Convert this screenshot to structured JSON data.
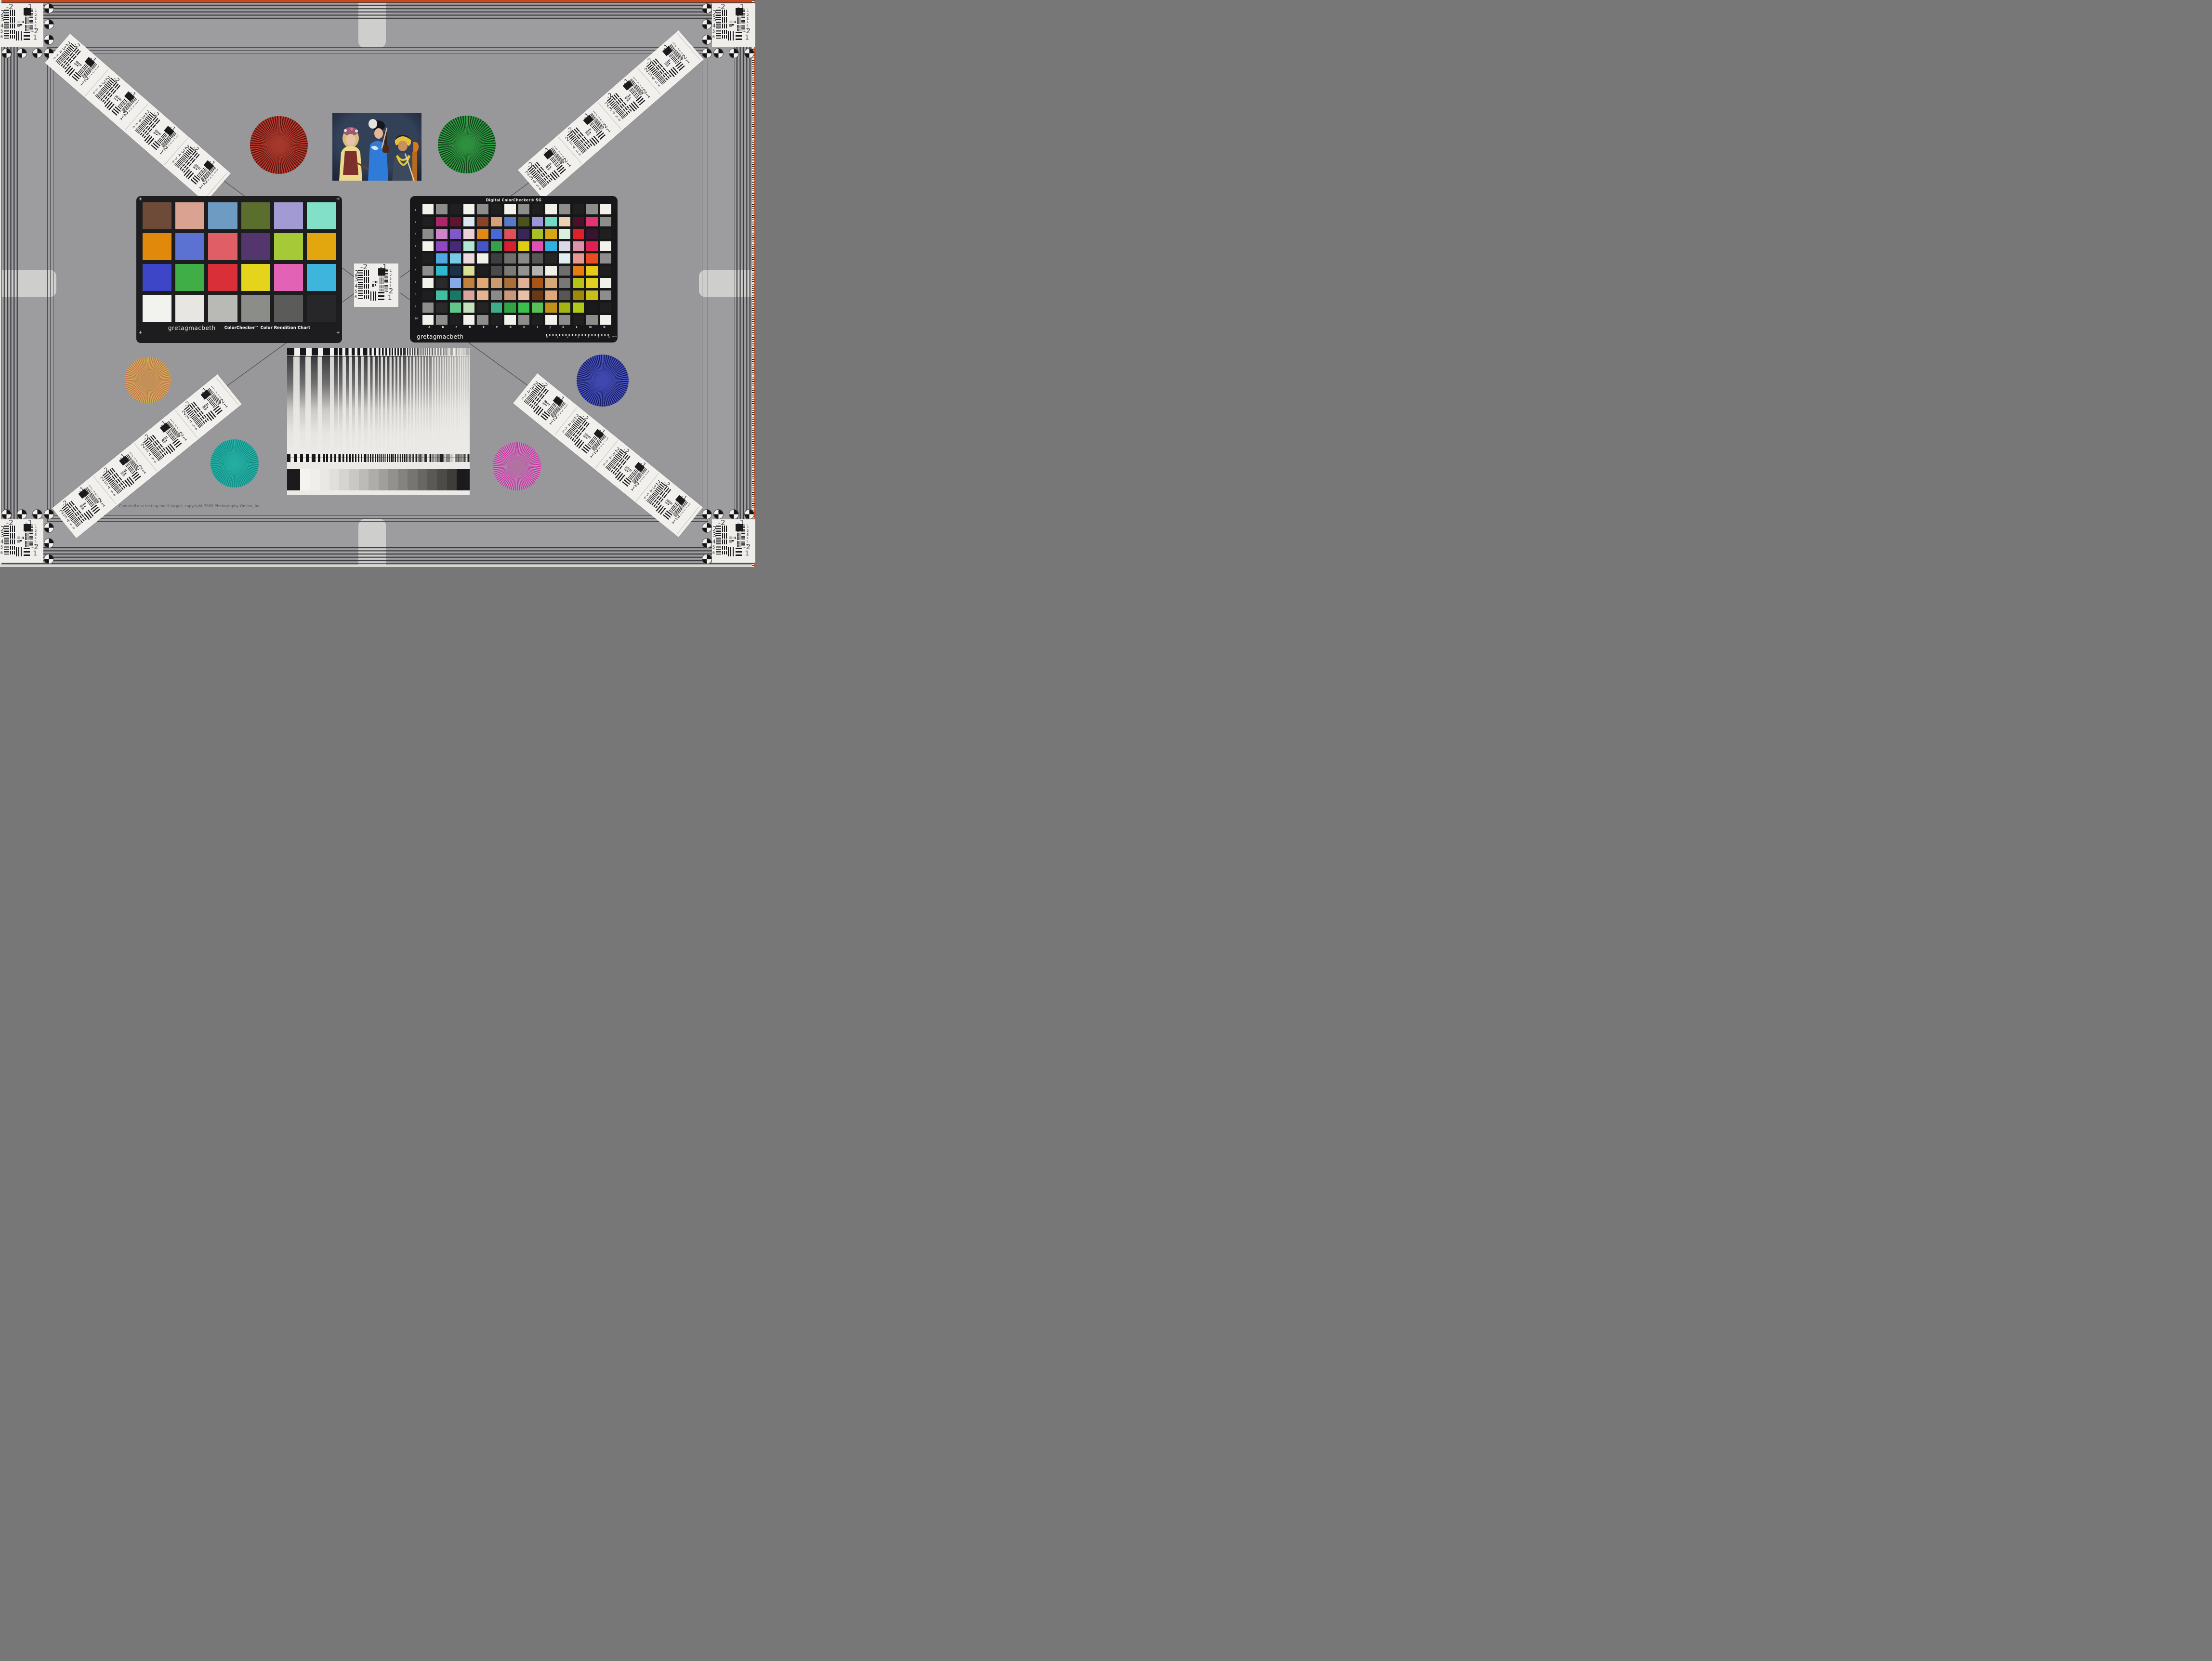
{
  "meta": {
    "chart_name": "Camera/Lens testing multi-target",
    "copyright_text": "Camera/Lens testing multi-target, copyright 2009 Photography Online, Inc.",
    "frame": {
      "orange_strip": "#c8481c",
      "field_gray": "#98989b",
      "band_line": "#2a2a2e",
      "cross_light": "#d3d3d0",
      "paper_white": "#efeeea"
    }
  },
  "colorchecker": {
    "brand": "gretagmacbeth",
    "title": "ColorChecker™ Color Rendition Chart",
    "rows": [
      [
        "#6e4a39",
        "#d9a291",
        "#6d9bc1",
        "#5c6e2d",
        "#a29ad2",
        "#82e0c8"
      ],
      [
        "#e1890b",
        "#5b72d2",
        "#e05f66",
        "#53366e",
        "#a6c938",
        "#e2a70e"
      ],
      [
        "#3e46c8",
        "#3fae46",
        "#d92f38",
        "#e5d41c",
        "#e263b6",
        "#3db5dd"
      ],
      [
        "#f2f2ee",
        "#e7e6e2",
        "#b9bab6",
        "#8b8d89",
        "#5b5c5a",
        "#272729"
      ]
    ]
  },
  "sg": {
    "title": "Digital ColorChecker® SG",
    "brand": "gretagmacbeth",
    "col_labels": [
      "A",
      "B",
      "C",
      "D",
      "E",
      "F",
      "G",
      "H",
      "I",
      "J",
      "K",
      "L",
      "M",
      "N"
    ],
    "row_labels": [
      "1",
      "2",
      "3",
      "4",
      "5",
      "6",
      "7",
      "8",
      "9",
      "10"
    ],
    "ruler_numbers": [
      "0",
      "1",
      "2",
      "3",
      "4",
      "5",
      "6"
    ],
    "ruler_unit": "mm",
    "grid": [
      [
        "#f2f1ea",
        "#8d8d8b",
        "#1f1f1f",
        "#f2f1ea",
        "#8d8d8b",
        "#1f1f1f",
        "#f2f1ea",
        "#8d8d8b",
        "#1f1f1f",
        "#f2f1ea",
        "#8d8d8b",
        "#1f1f1f",
        "#8d8d8b",
        "#f2f1ea"
      ],
      [
        "#1f1f1f",
        "#b02468",
        "#5f1430",
        "#dce8f0",
        "#8a4228",
        "#d8a078",
        "#5878c8",
        "#4a5220",
        "#9a96d8",
        "#72dcc2",
        "#ecd2b2",
        "#4c1028",
        "#e43570",
        "#8d8d8b"
      ],
      [
        "#8d8d8b",
        "#cc85c8",
        "#8058c8",
        "#ecd0d8",
        "#e08818",
        "#4868d8",
        "#dc5058",
        "#3a2656",
        "#a8c025",
        "#d4a812",
        "#d8f0dc",
        "#e02028",
        "#381430",
        "#1f1f1f"
      ],
      [
        "#f2f1ea",
        "#9048c0",
        "#482878",
        "#b2e6d4",
        "#4455c8",
        "#38a048",
        "#d42030",
        "#e0cc10",
        "#e050b0",
        "#30b0e0",
        "#dcd8e8",
        "#e090a8",
        "#e02050",
        "#f2f1ea"
      ],
      [
        "#1f1f1f",
        "#50a8e0",
        "#78c8e8",
        "#ecd8dc",
        "#f0efe8",
        "#3e3e40",
        "#6e6e6c",
        "#8a8a88",
        "#565654",
        "#262626",
        "#e0eef0",
        "#e89890",
        "#e84c20",
        "#8d8d8b"
      ],
      [
        "#8d8d8b",
        "#30b8cc",
        "#1c3048",
        "#d8e098",
        "#1e1e1e",
        "#4a4a4a",
        "#7c7a74",
        "#929290",
        "#b2b2b0",
        "#f0efe8",
        "#6e6e6c",
        "#e87c10",
        "#e8c818",
        "#1f1f1f"
      ],
      [
        "#f2f1ea",
        "#2a2a2a",
        "#88aae8",
        "#c08040",
        "#e0a878",
        "#c89c70",
        "#a87038",
        "#e0b098",
        "#a85618",
        "#d8a876",
        "#787876",
        "#b8c214",
        "#e0d020",
        "#f2f1ea"
      ],
      [
        "#1f1f1f",
        "#40c0a0",
        "#187868",
        "#d8a49c",
        "#e8b490",
        "#8a8a88",
        "#c89878",
        "#e8c0a8",
        "#6a3814",
        "#e0a878",
        "#565654",
        "#a08808",
        "#c8c018",
        "#8d8d8b"
      ],
      [
        "#8d8d8b",
        "#2a2a2a",
        "#60c888",
        "#c4e0bc",
        "#242424",
        "#40ac88",
        "#30a444",
        "#3cc04c",
        "#58c058",
        "#c09018",
        "#a4b414",
        "#b0c818",
        "#1a1a1a",
        "#1f1f1f"
      ],
      [
        "#f2f1ea",
        "#8d8d8b",
        "#1f1f1f",
        "#f2f1ea",
        "#8d8d8b",
        "#1f1f1f",
        "#f2f1ea",
        "#8d8d8b",
        "#1f1f1f",
        "#f2f1ea",
        "#8d8d8b",
        "#1f1f1f",
        "#8d8d8b",
        "#f2f1ea"
      ]
    ]
  },
  "usaf": {
    "top_labels": [
      "-2",
      "-1"
    ],
    "left_numbers": [
      "2",
      "3",
      "4",
      "5",
      "6"
    ],
    "right_numbers": [
      "1",
      "2",
      "3",
      "4",
      "5",
      "6"
    ],
    "bottom_labels": [
      "-2",
      "1"
    ]
  },
  "stars": [
    {
      "name": "red",
      "light": "#bf3a2f",
      "dark": "#57160f",
      "center": "#a5382c"
    },
    {
      "name": "green",
      "light": "#2f9e44",
      "dark": "#16401c",
      "center": "#2e8f3e"
    },
    {
      "name": "gold",
      "light": "#ccb35e",
      "dark": "#c4714a",
      "center": "#c29058"
    },
    {
      "name": "teal",
      "light": "#27b3a8",
      "dark": "#128c84",
      "center": "#24aca1"
    },
    {
      "name": "blue",
      "light": "#4a55c4",
      "dark": "#181d5e",
      "center": "#3f48ae"
    },
    {
      "name": "magenta",
      "light": "#c9339f",
      "dark": "#b795b8",
      "center": "#b172a2"
    }
  ],
  "sweep": {
    "card_bg": "#eceae6",
    "top_periods": [
      30,
      24,
      20,
      16,
      13,
      11,
      9,
      7,
      6,
      5,
      4,
      3.2,
      2.6,
      2.2
    ],
    "main_periods": [
      26,
      22,
      19,
      16,
      14,
      12,
      10.5,
      9,
      8,
      7,
      6,
      5.5,
      5,
      4.5
    ],
    "bottom_periods": [
      14,
      12,
      10,
      8.5,
      7,
      6,
      5,
      4.2,
      3.6,
      3,
      2.6,
      2.2,
      1.9,
      1.6
    ],
    "wedge_steps": [
      "#f4f3f0",
      "#efeeea",
      "#e9e8e4",
      "#e0dfdb",
      "#d5d4d0",
      "#c9c8c4",
      "#bcbbb7",
      "#aeada9",
      "#a09f9b",
      "#92918d",
      "#848380",
      "#767572",
      "#686764",
      "#5a5956",
      "#4c4b48",
      "#3e3d3a"
    ]
  },
  "photo": {
    "description": "three costumed musicians with violins and cello",
    "palette": {
      "background": "#324058",
      "blouse_yellow": "#ecd98e",
      "vest_red": "#7c2f2b",
      "robe_blue": "#2f7bd8",
      "headband_yellow": "#e6c23c",
      "necklace_yellow": "#e8c830"
    }
  }
}
